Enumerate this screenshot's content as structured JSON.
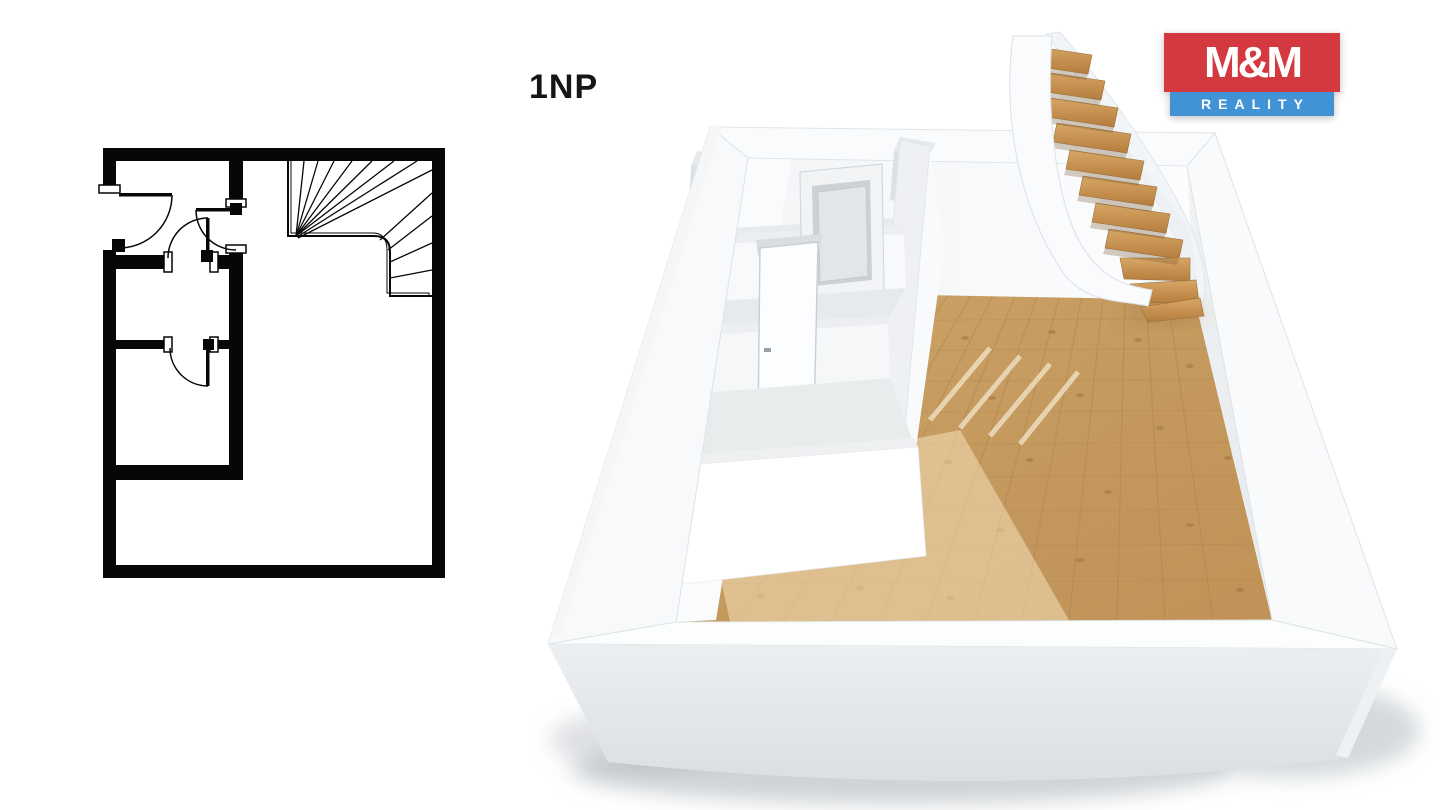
{
  "header": {
    "floor_label": "1NP"
  },
  "logo": {
    "line1": "M&M",
    "line2": "REALITY",
    "red": "#d53940",
    "blue": "#4193d6",
    "text_color": "#ffffff"
  },
  "plan2d": {
    "icon": "2d-floorplan-drawing",
    "wall_color": "#000000",
    "background": "#ffffff",
    "features": [
      "entry-door",
      "hall-door",
      "room-door",
      "lower-room-door",
      "winder-staircase"
    ]
  },
  "plan3d": {
    "icon": "3d-floorplan-render",
    "wall_color": "#f7f9fb",
    "wood_floor_color": "#c89c62",
    "stair_wood_color": "#c38d4f",
    "features": [
      "white-walls",
      "wood-floor",
      "winder-staircase",
      "open-door",
      "standing-door"
    ]
  }
}
